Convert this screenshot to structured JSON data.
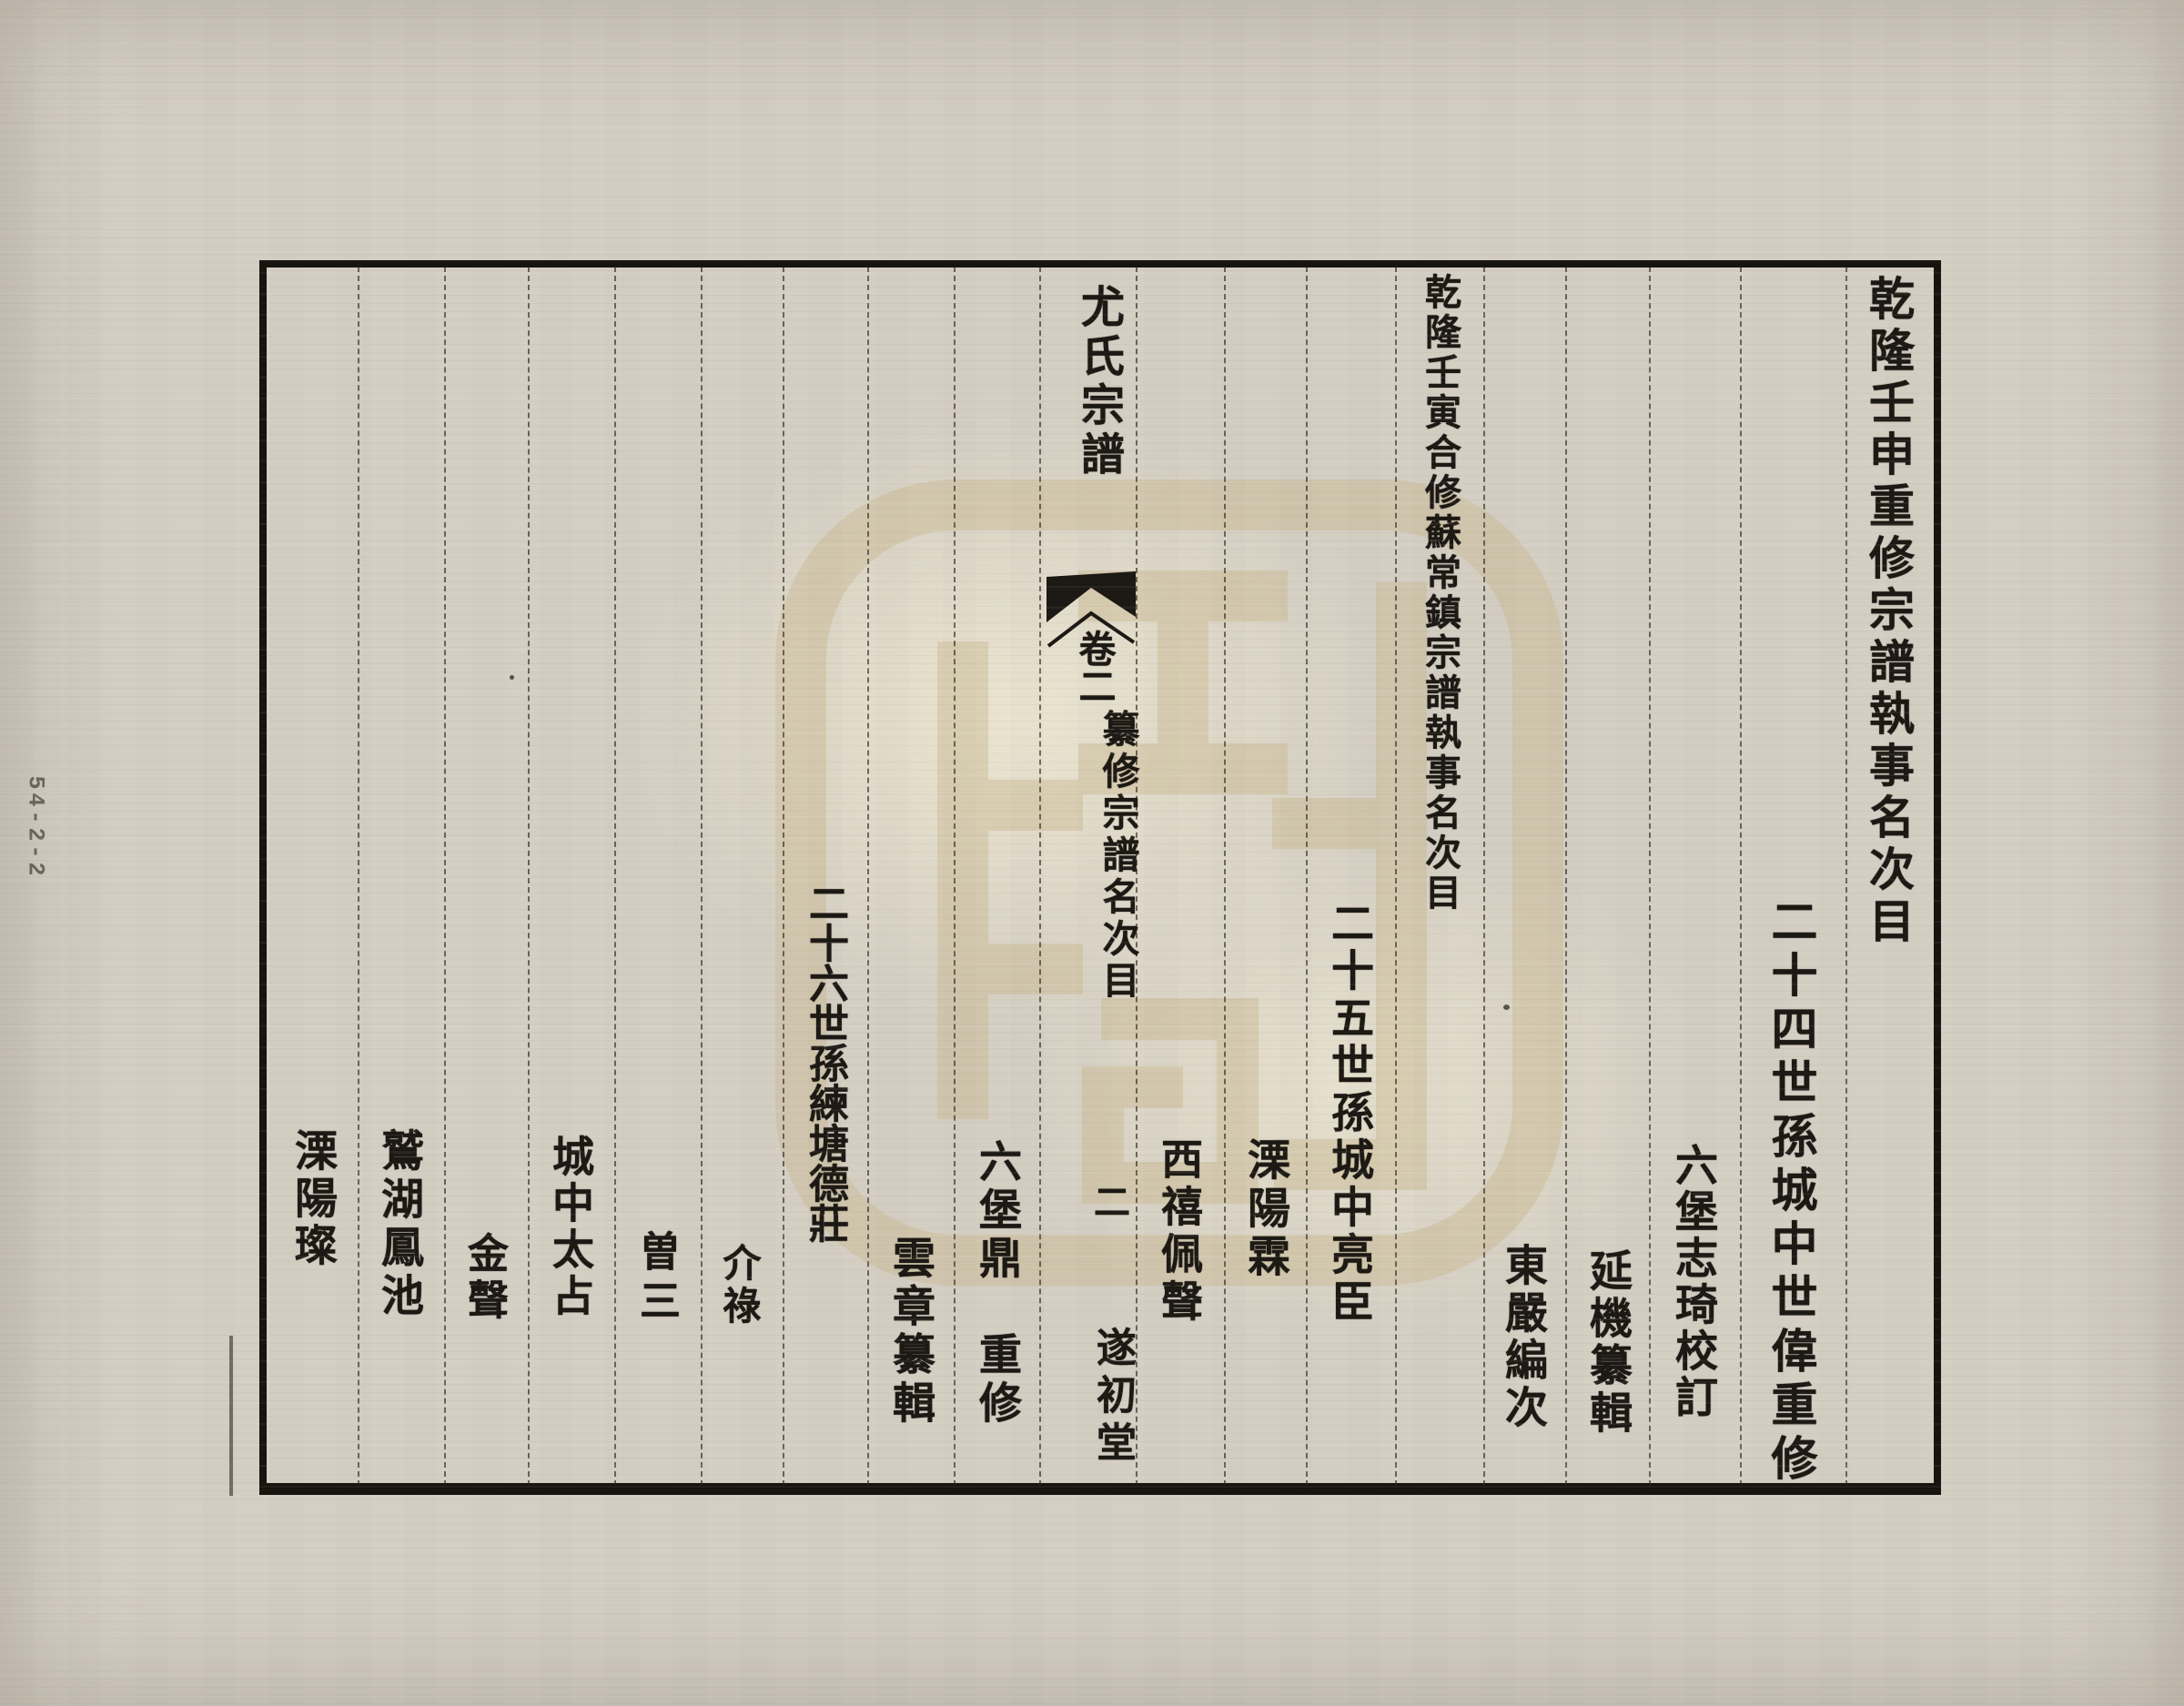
{
  "document": {
    "archive_label": "54-2-2",
    "banxin": {
      "book_title": "尤氏宗譜",
      "volume": "卷二",
      "section_title": "纂修宗譜名次目",
      "page_number": "二",
      "hall_name": "遂初堂"
    },
    "right_page_columns": [
      "乾隆壬申重修宗譜執事名次目",
      "二十四世孫城中世偉重修",
      "六堡志琦校訂",
      "延機纂輯",
      "東嚴編次",
      "乾隆壬寅合修蘇常鎮宗譜執事名次目",
      "二十五世孫城中亮臣",
      "溧陽霖",
      "西禧佩聲"
    ],
    "left_page_columns": [
      "六堡鼎　重修",
      "雲章纂輯",
      "二十六世孫練塘德莊",
      "介祿",
      "曽三",
      "城中太占",
      "金聲",
      "鷲湖鳳池",
      "溧陽璨"
    ]
  },
  "colors": {
    "paper": "#d4cec3",
    "ink": "#1c1813",
    "frame": "#17130e",
    "watermark": "#c9b88e"
  }
}
